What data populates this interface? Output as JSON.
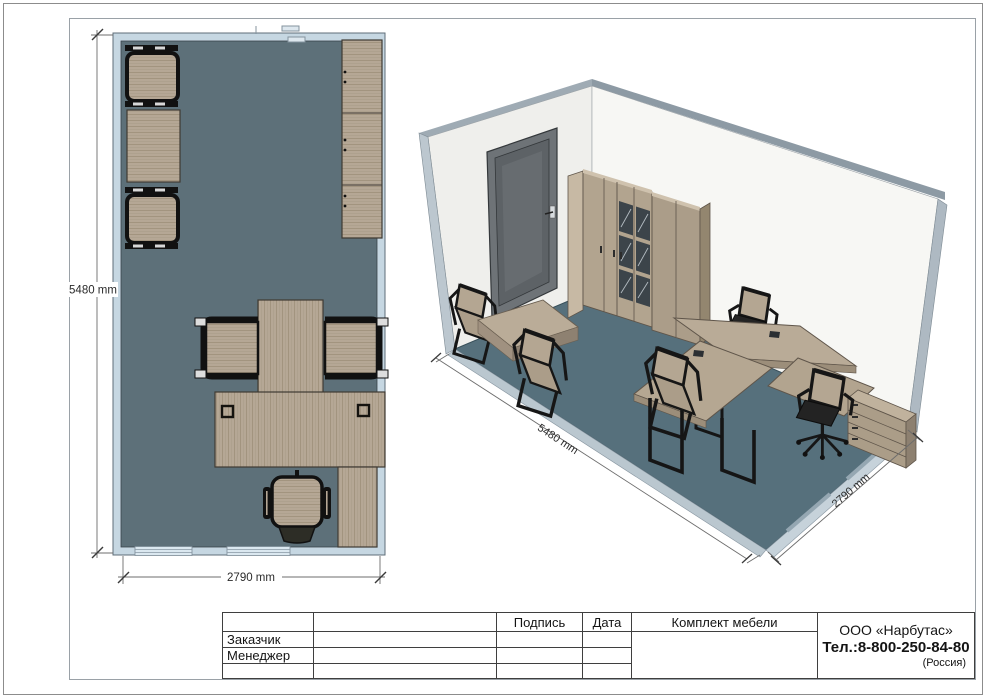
{
  "plan_view": {
    "dim_height": "5480 mm",
    "dim_width": "2790 mm"
  },
  "iso_view": {
    "dim_length": "5480 mm",
    "dim_depth": "2790 mm"
  },
  "title_block": {
    "col_signature": "Подпись",
    "col_date": "Дата",
    "col_furniture": "Комплект мебели",
    "row_customer": "Заказчик",
    "row_manager": "Менеджер",
    "company": {
      "name": "ООО «Нарбутас»",
      "phone": "Тел.:8-800-250-84-80",
      "country": "(Россия)"
    }
  },
  "colors": {
    "plan_wall": "#c6d7e2",
    "plan_floor": "#5d7079",
    "iso_floor": "#56707c",
    "wood": "#b5a795",
    "door": "#6e7377"
  }
}
